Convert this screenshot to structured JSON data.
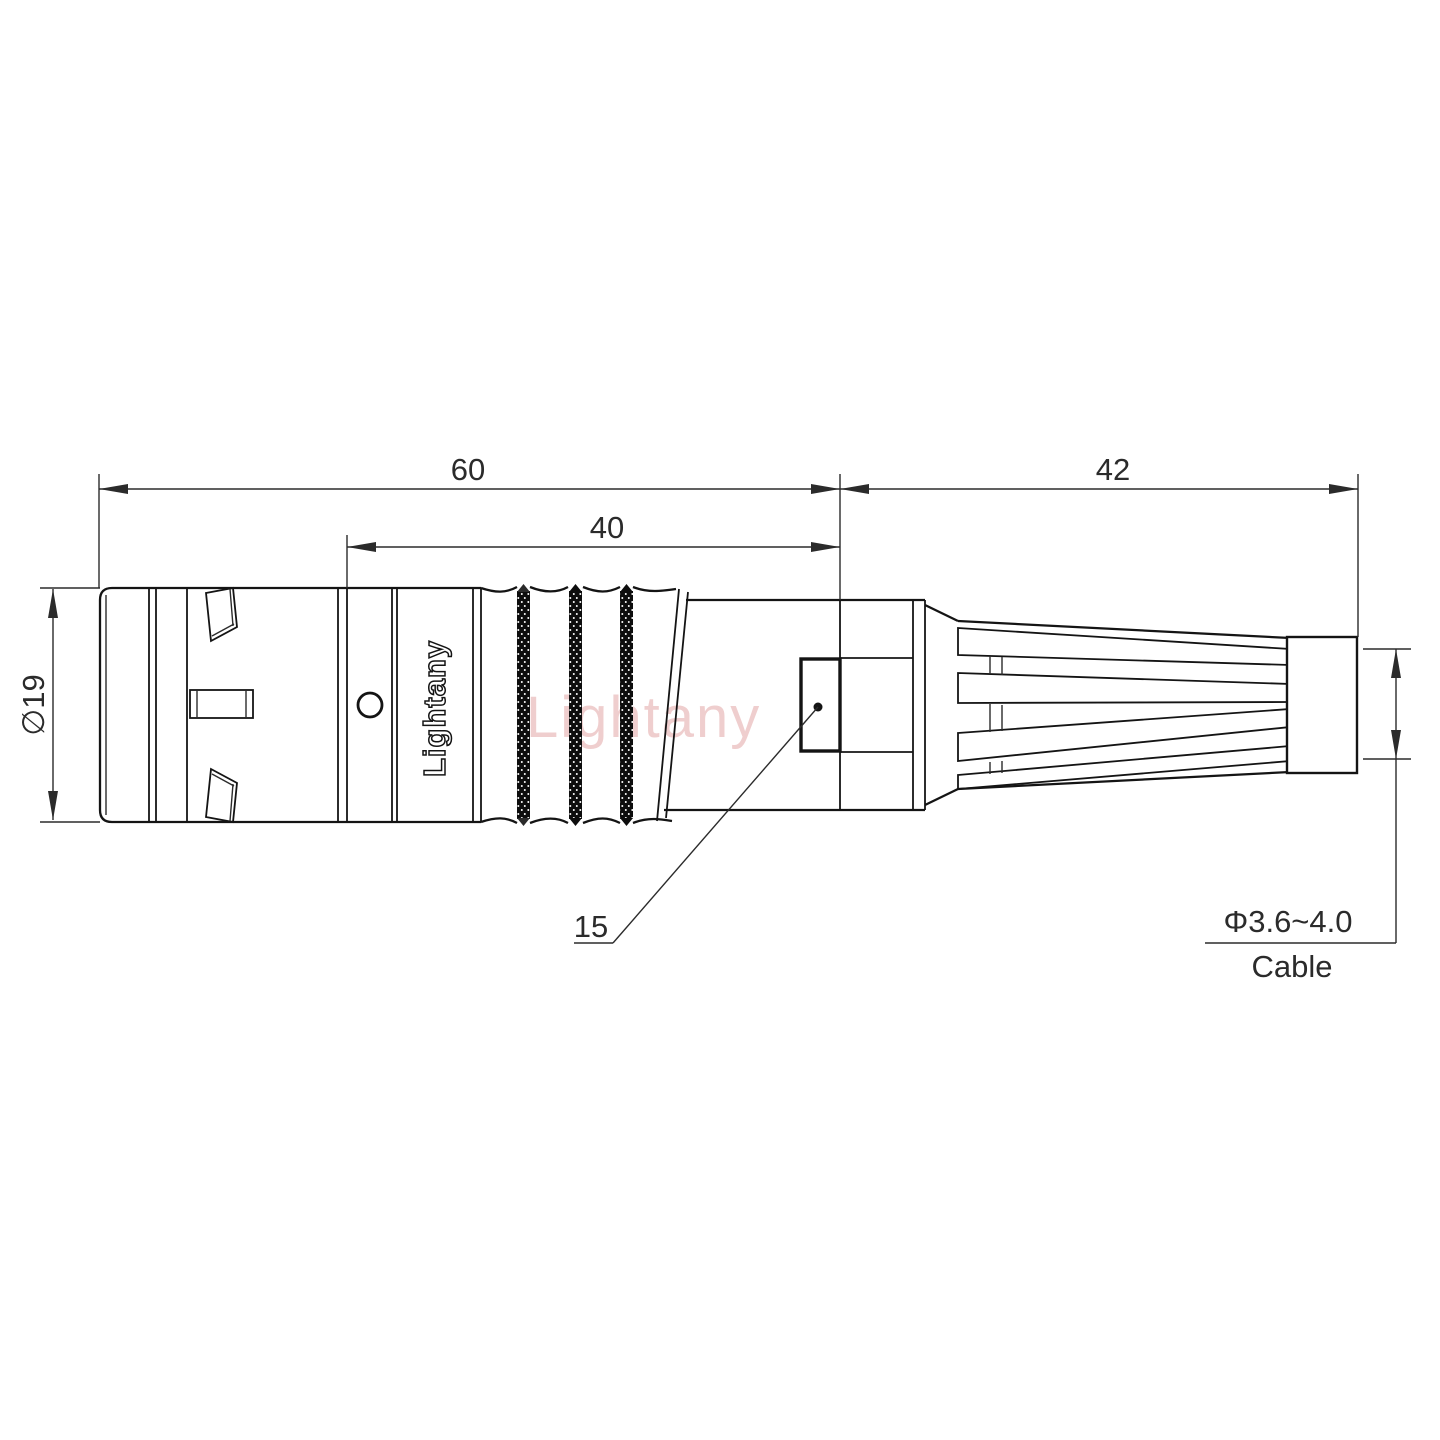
{
  "drawing": {
    "type": "connector-dimension-drawing",
    "brand_text_vertical": "Lightany",
    "watermark_text": "Lightany",
    "dimensions": {
      "overall_length": "60",
      "rear_length": "40",
      "boot_length": "42",
      "body_diameter": "∅19",
      "leader_ref": "15",
      "cable_diameter": "Φ3.6~4.0",
      "cable_label": "Cable"
    },
    "colors": {
      "line": "#141414",
      "dimension": "#2b2b2b",
      "watermark_pink": "#d88686",
      "background": "#ffffff"
    }
  }
}
